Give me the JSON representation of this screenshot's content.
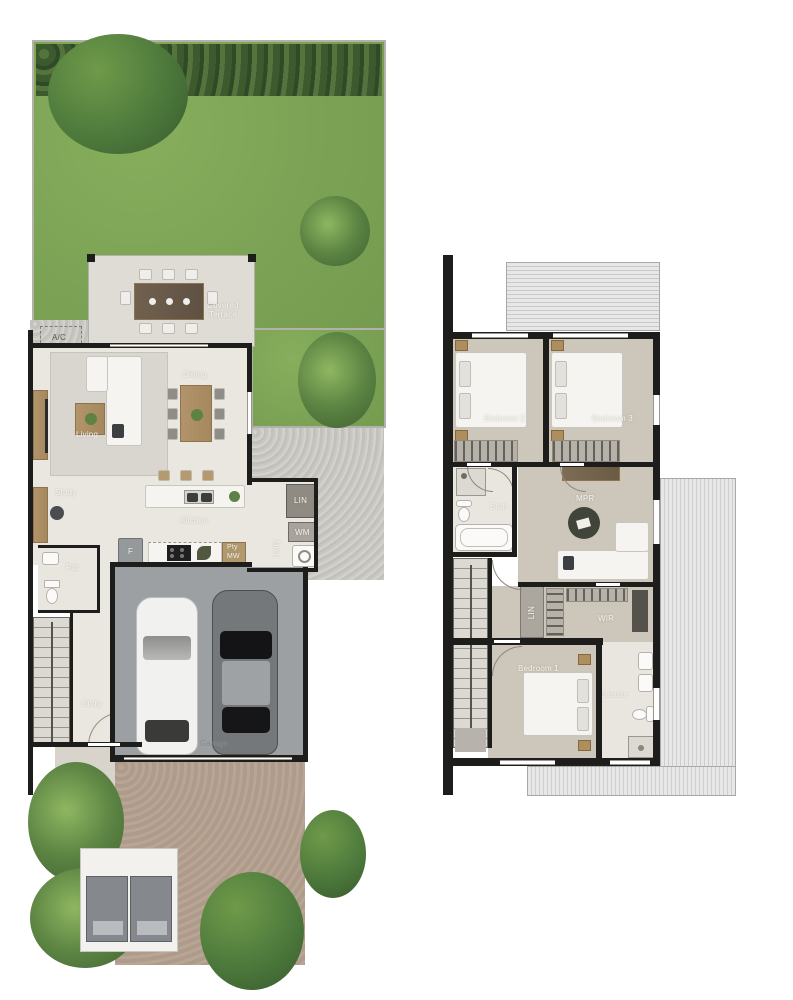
{
  "ground": {
    "name": "Ground Floor Plan",
    "labels": {
      "ac": "A/C",
      "terrace": "Covered Terrace",
      "dining": "Dining",
      "living": "Living",
      "study": "Study",
      "kitchen": "Kitchen",
      "lin": "LIN",
      "wm": "WM",
      "ldry": "Ldry",
      "pty": "Pty",
      "mw": "MW",
      "fridge": "F",
      "pdr": "Pdr",
      "entry": "Entry",
      "garage": "Garage",
      "porch": "Porch"
    }
  },
  "upper": {
    "name": "Upper Floor Plan",
    "labels": {
      "bedroom2": "Bedroom 2",
      "bedroom3": "Bedroom 3",
      "mpr": "MPR",
      "bath": "Bath",
      "lin": "LIN",
      "wir": "WIR",
      "bedroom1": "Bedroom 1",
      "ensuite": "Ensuite"
    }
  },
  "colors": {
    "grass": "#7ca355",
    "hedge": "#3c5a2e",
    "ground_floor": "#eae7e1",
    "terrace": "#dfdcd6",
    "upper_floor": "#cdc6bb",
    "garage_floor": "#9da0a3",
    "driveway": "#b3a091",
    "gravel": "#c8c6c1",
    "wall": "#1d1d1b",
    "wood": "#a98c62"
  }
}
